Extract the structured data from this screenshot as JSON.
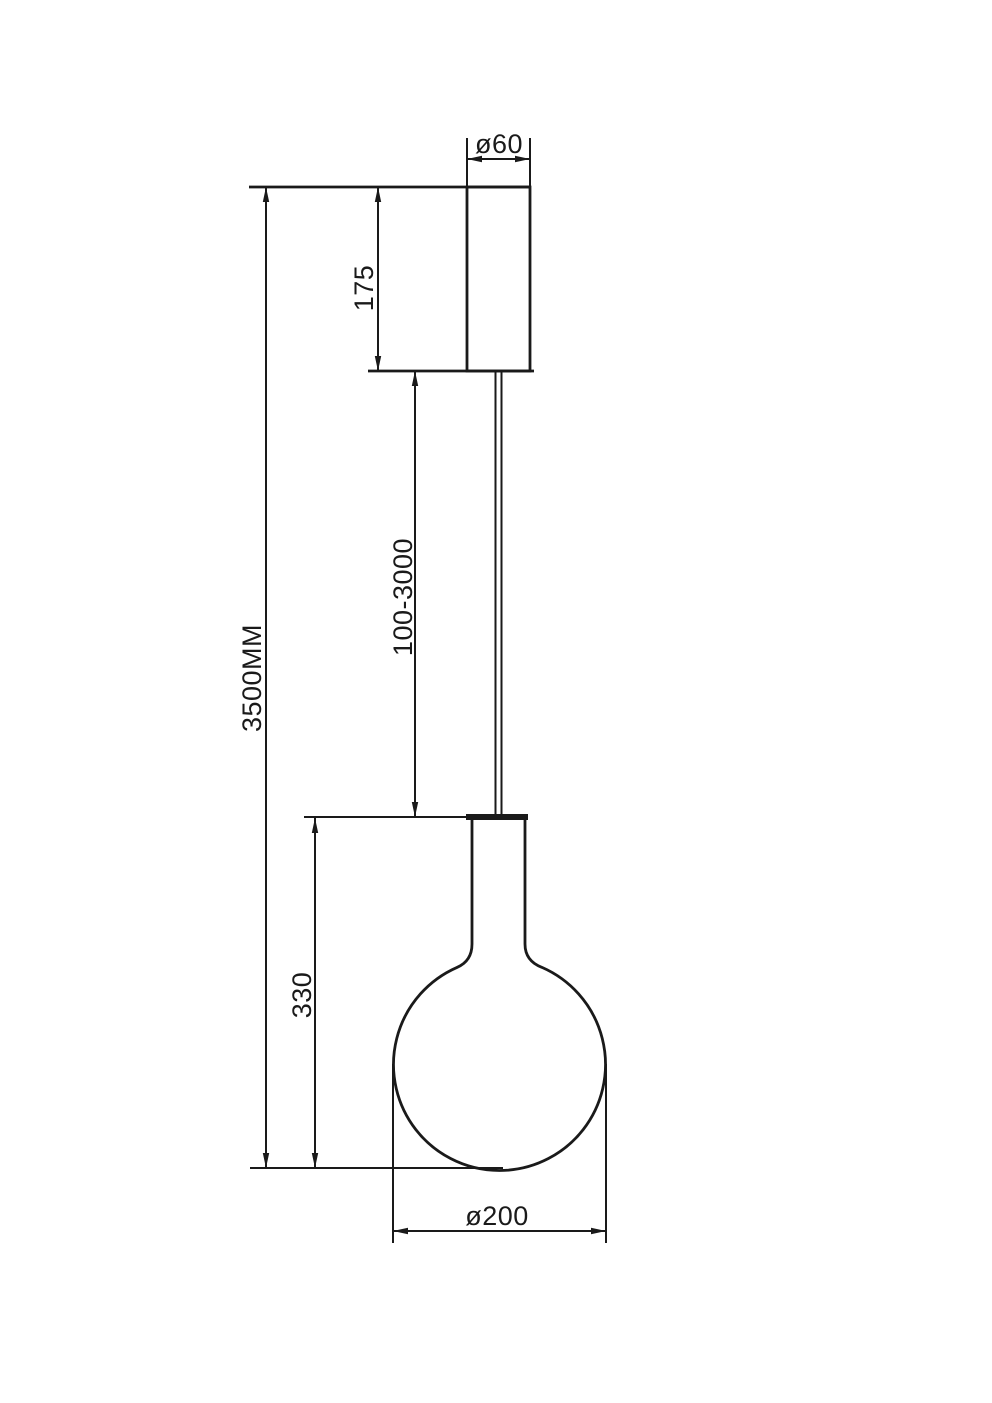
{
  "colors": {
    "background": "#ffffff",
    "line": "#1a1a1a"
  },
  "drawing": {
    "type": "pendant-lamp-dimension-drawing",
    "dimensions": {
      "canopy_diameter": "ø60",
      "canopy_height": "175",
      "suspension_length": "100-3000",
      "overall_height": "3500MM",
      "lamp_section_height": "330",
      "shade_diameter": "ø200"
    }
  }
}
